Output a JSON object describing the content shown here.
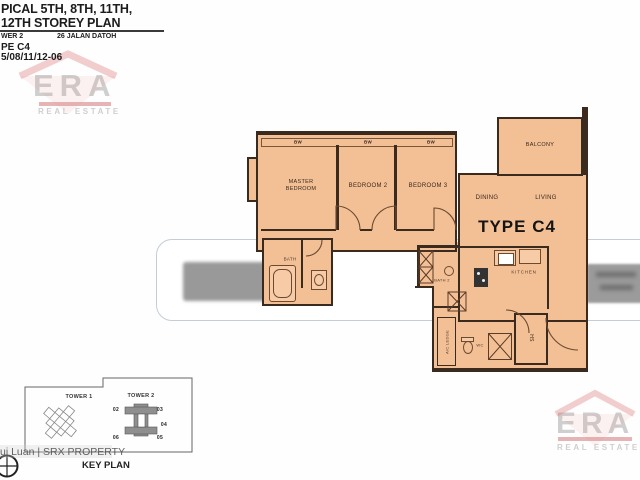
{
  "header": {
    "line1": "PICAL 5TH, 8TH, 11TH,",
    "line2": "12TH  STOREY  PLAN",
    "tower": "WER 2",
    "address": "26 JALAN DATOH",
    "type": "PE C4",
    "unit": "5/08/11/12-06"
  },
  "watermark": {
    "brand": "ERA",
    "brand_sub": "REAL ESTATE",
    "srx": "ui Luan | SRX PROPERTY"
  },
  "plan": {
    "type_label": "TYPE C4",
    "labels": {
      "master_bedroom_l1": "MASTER",
      "master_bedroom_l2": "BEDROOM",
      "bedroom2": "BEDROOM 2",
      "bedroom3": "BEDROOM 3",
      "balcony": "BALCONY",
      "dining": "DINING",
      "living": "LIVING",
      "kitchen": "KITCHEN",
      "bath": "BATH",
      "bath2": "BATH 2",
      "wc": "WC",
      "hs": "HS",
      "ac_ledge": "A/C LEDGE",
      "window": "BW"
    }
  },
  "keyplan": {
    "title": "KEY PLAN",
    "tower1": "TOWER 1",
    "tower2": "TOWER 2",
    "units": [
      "02",
      "03",
      "04",
      "06",
      "05"
    ]
  },
  "colors": {
    "plan_fill": "#f3c096",
    "wall": "#3b2a1e",
    "band_border": "#c4cdd4",
    "blur_gray": "#999999",
    "era_red": "#d98c8c",
    "era_gray": "#cfcfcf"
  }
}
